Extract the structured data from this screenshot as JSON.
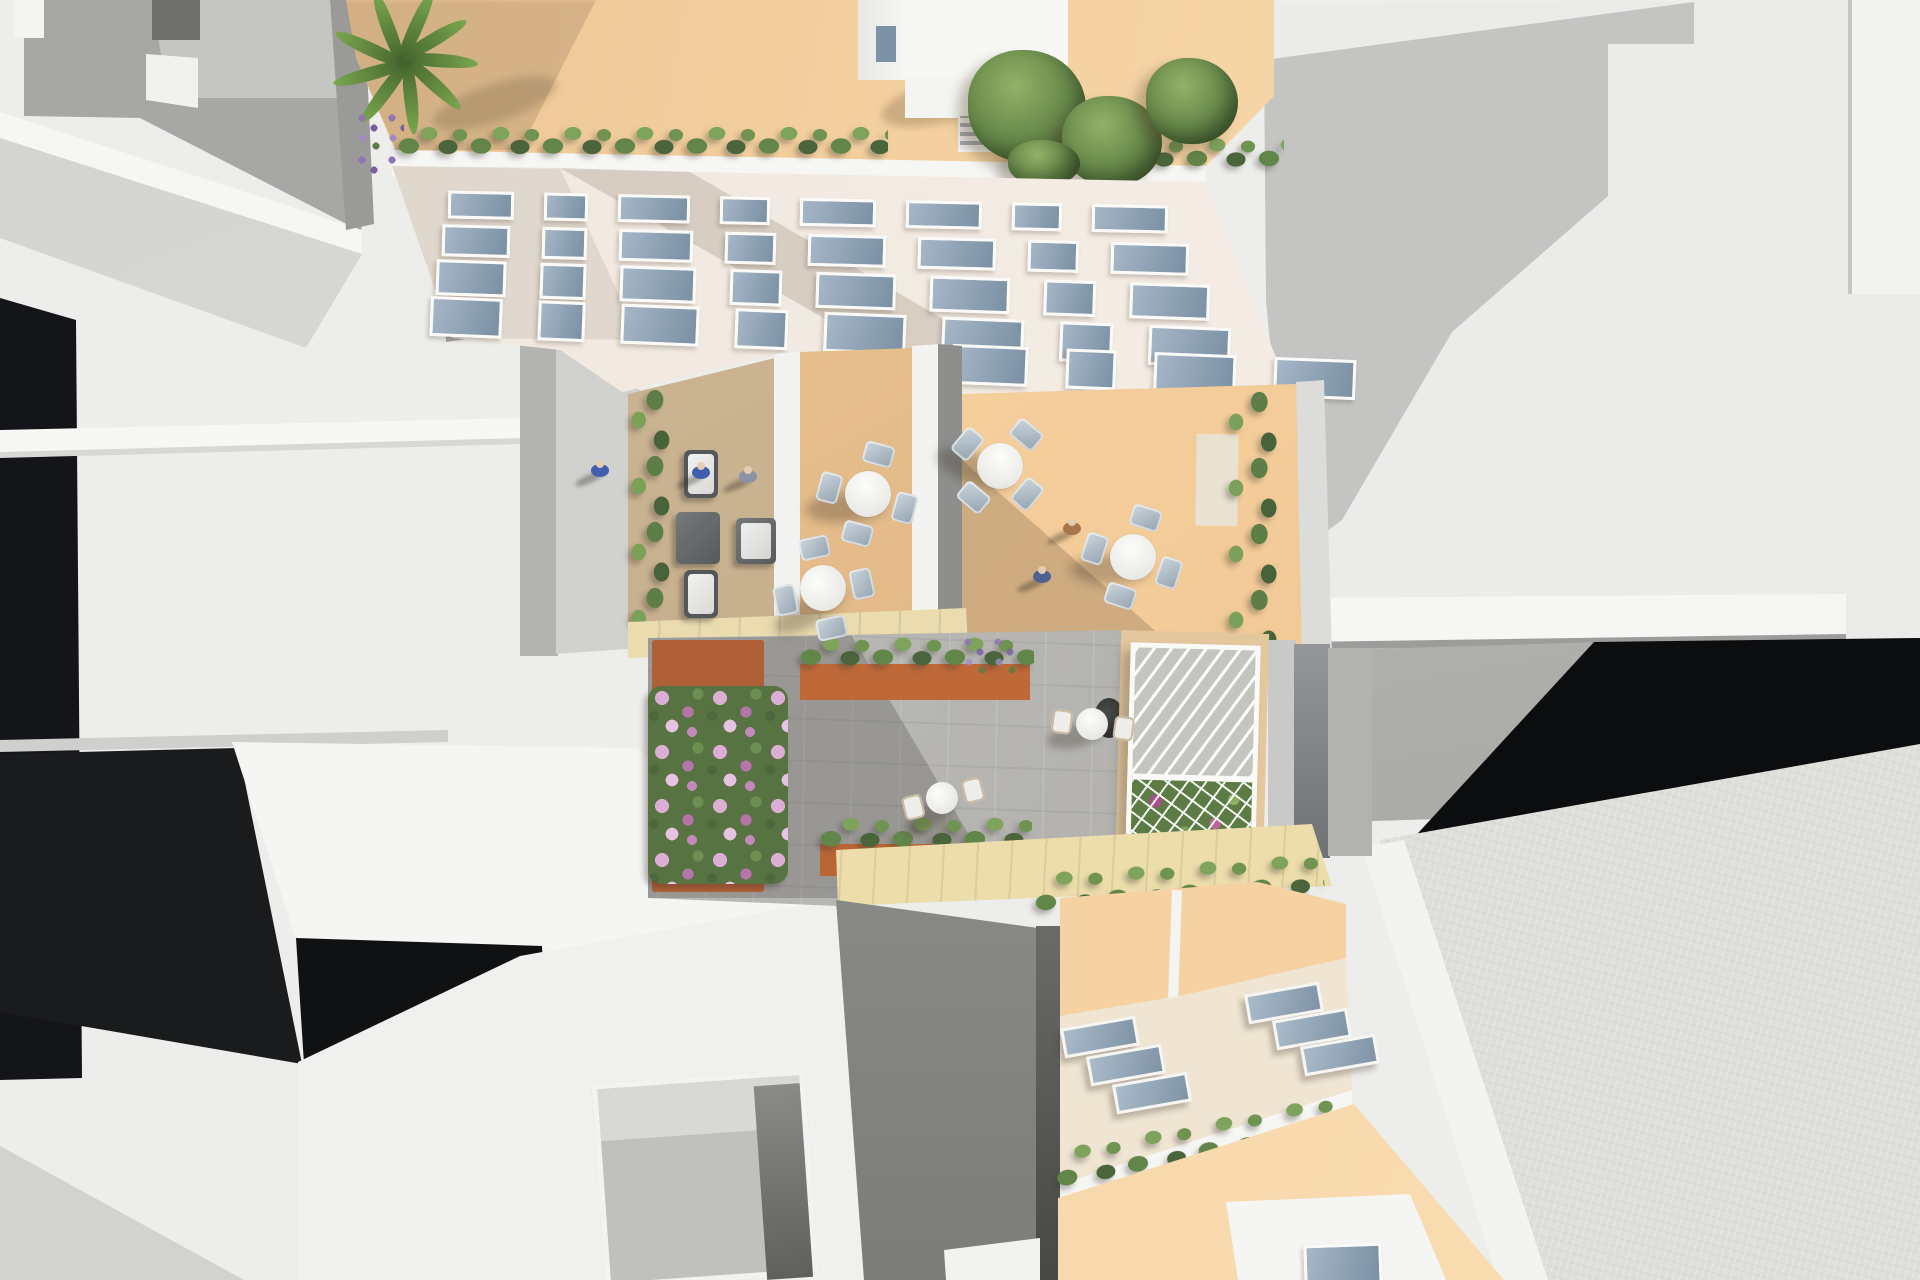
{
  "meta": {
    "type": "3d-architectural-aerial-render",
    "view": "top-down bird's-eye",
    "description": "Bird's-eye 3D rendering of an urban block: a white apartment building with peach rooftop terrace (palm, shrubs, penthouse with stair access), wooden amenity decks with cafe dining sets, a paved courtyard with corten planters, flower beds and a glass greenhouse, a lower building with skylight roof and hedge-lined terraces, surrounded by abstract white and gray massing buildings with deep cast shadows.",
    "visible_text": "none"
  },
  "palette": {
    "background": "#ededeb",
    "white_roof": "#f5f5f3",
    "gray_wall": "#a7a8a6",
    "deep_shadow": "#121316",
    "facade": "#f3ece4",
    "window_glass": "#8ba0b4",
    "window_frame": "#fafaf8",
    "rooftop_peach": "#f3cf9e",
    "deck_tan": "#c6b08e",
    "deck_orange": "#f2c893",
    "courtyard_paving": "#b5b4b0",
    "stone_band": "#eadcae",
    "corten_planter": "#bf6a39",
    "hedge_green": "#5d7f47",
    "flower_pink": "#c993c9",
    "skylight_blue": "#9db0c1",
    "cream_roof": "#f0e5d3",
    "peach_wall": "#f6d1a1"
  },
  "scene": {
    "main_building": {
      "rooftop": {
        "floor": "#f3cf9e",
        "penthouse": "white stair-access structure",
        "palm_trees": 1,
        "trees": 4,
        "shrub_rows": 2,
        "lavender_patches": 1
      },
      "facade": {
        "window_rows": [
          [
            60,
            38,
            66,
            44,
            70,
            70,
            44,
            70
          ],
          [
            62,
            39,
            68,
            45,
            72,
            72,
            45,
            72
          ],
          [
            64,
            40,
            70,
            46,
            74,
            74,
            46,
            74
          ],
          [
            66,
            41,
            72,
            47,
            76,
            76,
            47,
            76
          ],
          [
            70,
            44,
            76,
            76
          ]
        ],
        "side_windows": 2
      }
    },
    "terraces": {
      "lounge_deck": {
        "floor": "#c6b08e",
        "armchairs": 2,
        "ottomans": 2,
        "people": 2,
        "planting": "west edge shrubs"
      },
      "center_deck": {
        "floor": "#e2b885",
        "dining_sets": 2
      },
      "right_deck": {
        "floor": "#f2c893",
        "dining_sets": 2,
        "people": 2,
        "hedge": "east edge"
      }
    },
    "courtyard": {
      "paving": "#b5b4b0",
      "planters": "corten steel with shrubs and purple flowers",
      "flower_bed": "pink and purple blossoms",
      "bistro_sets": 2,
      "greenhouse": {
        "frame": "#fafaf8",
        "glazing": "diagonal glass panels",
        "contents": "flower and vegetable beds"
      }
    },
    "south_building": {
      "roof": "#f0e5d3",
      "skylights": 6,
      "walls": "#f6d1a1",
      "hedge_rows": 2,
      "penthouse_window": "#9db0c1"
    },
    "context": {
      "north_west": "white and gray massing with recessed courtyard",
      "east": "white flat roof with stepped cast shadow",
      "south_west": "white block with square light well",
      "south_east": "textured concrete block",
      "shadows": "#121316"
    },
    "furniture": {
      "dining_sets": [
        {
          "x": 868,
          "y": 494,
          "rot": 15
        },
        {
          "x": 823,
          "y": 588,
          "rot": -12
        },
        {
          "x": 1000,
          "y": 466,
          "rot": 40
        },
        {
          "x": 1133,
          "y": 557,
          "rot": 18
        }
      ],
      "bistro_sets": [
        {
          "x": 942,
          "y": 798,
          "rot": -14
        },
        {
          "x": 1092,
          "y": 724,
          "rot": 8
        }
      ],
      "skylights": [
        {
          "x": 1062,
          "y": 1022
        },
        {
          "x": 1088,
          "y": 1050
        },
        {
          "x": 1114,
          "y": 1078
        },
        {
          "x": 1246,
          "y": 988
        },
        {
          "x": 1274,
          "y": 1014
        },
        {
          "x": 1302,
          "y": 1040
        }
      ]
    },
    "people": [
      {
        "x": 600,
        "y": 470,
        "color": "#3f5fae"
      },
      {
        "x": 748,
        "y": 476,
        "color": "#8a93a5"
      },
      {
        "x": 1072,
        "y": 528,
        "color": "#a8764a"
      },
      {
        "x": 1042,
        "y": 576,
        "color": "#50618f"
      }
    ],
    "rooftop_trees": [
      {
        "x": 968,
        "y": 50,
        "w": 118,
        "h": 112
      },
      {
        "x": 1062,
        "y": 96,
        "w": 100,
        "h": 90
      },
      {
        "x": 1146,
        "y": 58,
        "w": 92,
        "h": 86
      },
      {
        "x": 1008,
        "y": 140,
        "w": 72,
        "h": 46
      }
    ]
  }
}
